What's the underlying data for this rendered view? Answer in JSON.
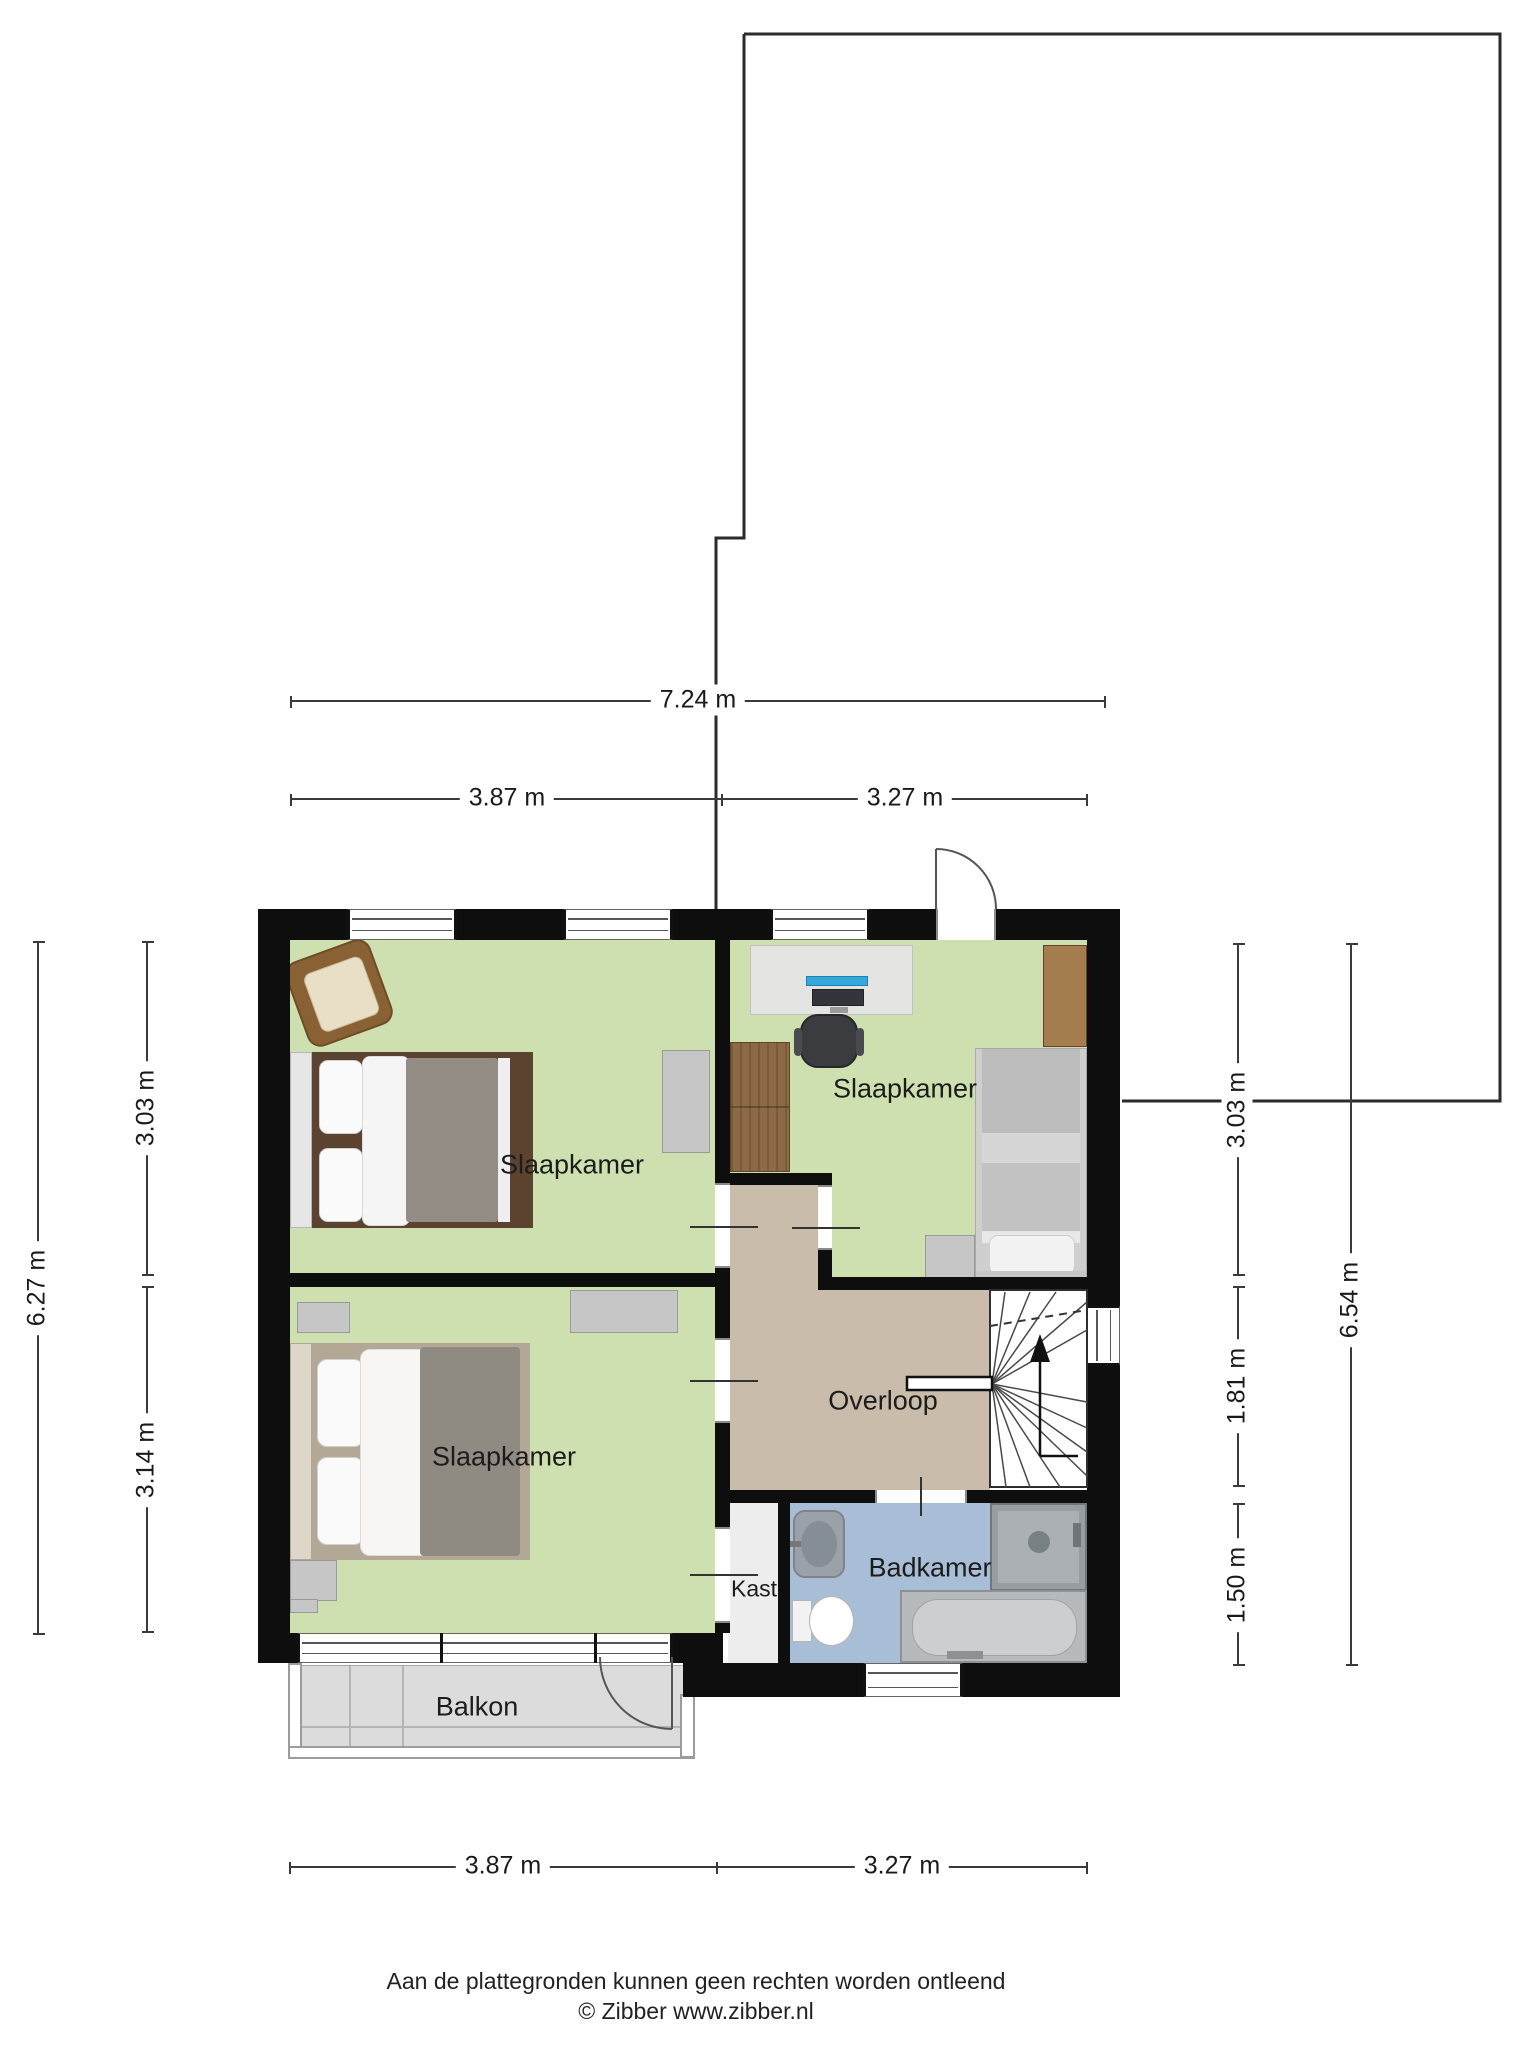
{
  "title": "Floor plan - first floor (verdieping)",
  "rooms": {
    "bedroom_top_left": "Slaapkamer",
    "bedroom_right": "Slaapkamer",
    "bedroom_bottom_left": "Slaapkamer",
    "landing": "Overloop",
    "closet": "Kast",
    "bathroom": "Badkamer",
    "balcony": "Balkon"
  },
  "dimensions": {
    "top_total": "7.24 m",
    "top_left": "3.87 m",
    "top_right": "3.27 m",
    "bottom_left": "3.87 m",
    "bottom_right": "3.27 m",
    "left_upper": "3.03 m",
    "left_lower": "3.14 m",
    "left_total": "6.27 m",
    "right_upper": "3.03 m",
    "right_middle": "1.81 m",
    "right_lower": "1.50 m",
    "right_total": "6.54 m"
  },
  "footer": {
    "line1": "Aan de plattegronden kunnen geen rechten worden ontleend",
    "line2": "© Zibber www.zibber.nl"
  },
  "colors": {
    "wall": "#0e0e0e",
    "floor_bedroom": "#cee0af",
    "floor_landing": "#c9bcab",
    "floor_bathroom": "#a8bdd6",
    "floor_closet": "#ededed",
    "floor_balcony": "#dcdcdc",
    "furniture_gray": "#c6c6c6",
    "wood_dark": "#5b4330",
    "wood_mid": "#8b6a45",
    "bed_blanket_gray": "#938d85",
    "desk": "#e4e4e2",
    "monitor_accent": "#35a8dc",
    "outline": "#2b2b2b",
    "dimension_lines": "#3a3a3a"
  }
}
